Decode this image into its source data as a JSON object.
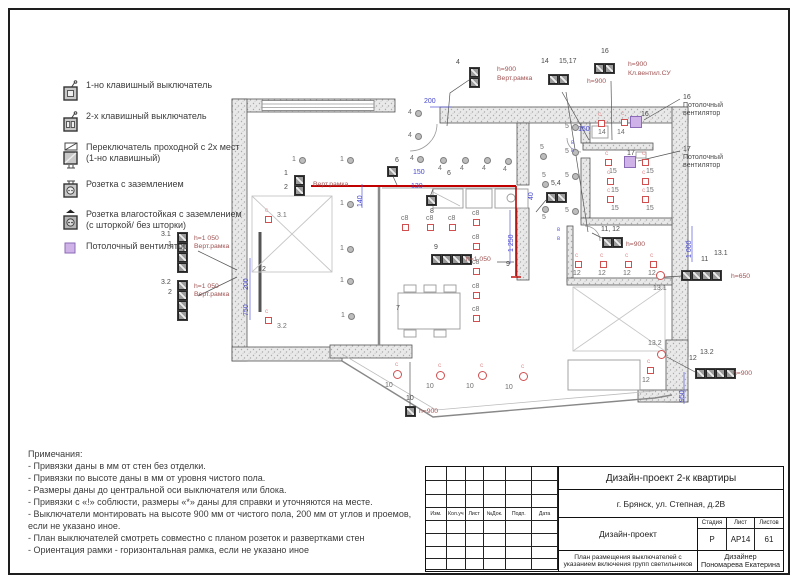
{
  "legend": {
    "items": [
      {
        "icon": "switch-1key-icon",
        "label": "1-но клавишный выключатель"
      },
      {
        "icon": "switch-2key-icon",
        "label": "2-х клавишный выключатель"
      },
      {
        "icon": "switch-pass-icon",
        "label": "Переключатель проходной с 2х мест (1-но клавишный)"
      },
      {
        "icon": "socket-ground-icon",
        "label": "Розетка с заземлением"
      },
      {
        "icon": "socket-wet-icon",
        "label": "Розетка влагостойкая с заземлением (с шторкой/ без шторки)"
      },
      {
        "icon": "ceiling-fan-icon",
        "label": "Потолочный вентилятор"
      }
    ]
  },
  "notes": {
    "title": "Примечания:",
    "lines": [
      "- Привязки даны в мм от стен без отделки.",
      "- Привязки по высоте даны в мм от уровня чистого пола.",
      "- Размеры даны до центральной оси выключателя или блока.",
      "- Привязки с «!» соблюсти, размеры «*» даны для справки и уточняются на месте.",
      "- Выключатели монтировать на высоте 900 мм от чистого пола, 200 мм от углов и проемов, если не указано иное.",
      "- План выключателей смотреть совместно с планом розеток и развертками стен",
      "- Ориентация рамки - горизонтальная рамка, если не указано иное"
    ]
  },
  "title_block": {
    "project": "Дизайн-проект 2-к квартиры",
    "address": "г. Брянск, ул. Степная, д.2В",
    "doc_type": "Дизайн-проект",
    "stage_label": "Стадия",
    "sheet_label": "Лист",
    "sheets_label": "Листов",
    "stage": "Р",
    "sheet": "АР14",
    "sheets": "61",
    "drawing_title": "План размещения выключателей с указанием включения групп светильников",
    "designer_label": "Дизайнер",
    "designer_name": "Пономарева Екатерина",
    "stamp_headers": [
      "Изм.",
      "Кол.уч",
      "Лист",
      "№Док.",
      "Подп.",
      "Дата"
    ]
  },
  "plan": {
    "ceiling_lights": [
      [
        302,
        160,
        "1",
        -10,
        -4
      ],
      [
        350,
        160,
        "1",
        -10,
        -4
      ],
      [
        350,
        204,
        "1",
        -10,
        -4
      ],
      [
        350,
        249,
        "1",
        -10,
        -4
      ],
      [
        350,
        281,
        "1",
        -10,
        -4
      ],
      [
        351,
        316,
        "1",
        -10,
        -4
      ],
      [
        418,
        113,
        "4",
        -10,
        -4
      ],
      [
        418,
        136,
        "4",
        -10,
        -4
      ],
      [
        420,
        159,
        "4",
        -10,
        -4
      ],
      [
        443,
        160,
        "4",
        -5,
        5
      ],
      [
        465,
        160,
        "4",
        -5,
        5
      ],
      [
        487,
        160,
        "4",
        -5,
        5
      ],
      [
        508,
        161,
        "4",
        -5,
        5
      ],
      [
        543,
        156,
        "5",
        -3,
        -12
      ],
      [
        575,
        127,
        "5",
        -10,
        -4
      ],
      [
        575,
        152,
        "5",
        -10,
        -4
      ],
      [
        575,
        176,
        "5",
        -10,
        -4
      ],
      [
        575,
        211,
        "5",
        -10,
        -4
      ],
      [
        545,
        184,
        "5",
        -3,
        -12
      ],
      [
        545,
        209,
        "5",
        -3,
        5
      ]
    ],
    "wall_lights_sq": [
      [
        268,
        219,
        "3.1",
        9,
        -7,
        true
      ],
      [
        268,
        320,
        "3.2",
        9,
        3,
        true
      ],
      [
        601,
        123,
        "14",
        -3,
        6,
        true
      ],
      [
        624,
        122,
        "14",
        -7,
        7,
        true
      ],
      [
        608,
        162,
        "15",
        1,
        6,
        true
      ],
      [
        645,
        162,
        "15",
        1,
        6,
        true
      ],
      [
        610,
        181,
        "15",
        1,
        6,
        true
      ],
      [
        645,
        181,
        "15",
        1,
        6,
        true
      ],
      [
        610,
        199,
        "15",
        1,
        6,
        true
      ],
      [
        645,
        199,
        "15",
        1,
        6,
        true
      ],
      [
        578,
        264,
        "12",
        -5,
        6,
        true
      ],
      [
        603,
        264,
        "12",
        -5,
        6,
        true
      ],
      [
        628,
        264,
        "12",
        -5,
        6,
        true
      ],
      [
        653,
        264,
        "12",
        -5,
        6,
        true
      ],
      [
        650,
        370,
        "12",
        -8,
        7,
        true
      ],
      [
        405,
        227,
        "с8",
        -4,
        -12,
        false
      ],
      [
        430,
        227,
        "с8",
        -4,
        -12,
        false
      ],
      [
        452,
        227,
        "с8",
        -4,
        -12,
        false
      ],
      [
        476,
        222,
        "с8",
        -4,
        -12,
        false
      ],
      [
        476,
        246,
        "с8",
        -4,
        -12,
        false
      ],
      [
        476,
        271,
        "с8",
        -4,
        -12,
        false
      ],
      [
        476,
        295,
        "с8",
        -4,
        -12,
        false
      ],
      [
        476,
        318,
        "с8",
        -4,
        -12,
        false
      ]
    ],
    "wall_lights_rd": [
      [
        397,
        374,
        "10",
        -12,
        8,
        true
      ],
      [
        440,
        375,
        "10",
        -14,
        8,
        true
      ],
      [
        482,
        375,
        "10",
        -16,
        8,
        true
      ],
      [
        523,
        376,
        "10",
        -18,
        8,
        true
      ],
      [
        660,
        275,
        "13.1",
        -7,
        10,
        false
      ],
      [
        661,
        354,
        "13.2",
        -13,
        -14,
        false
      ]
    ],
    "fans": [
      [
        636,
        122,
        "16",
        5,
        -11
      ],
      [
        630,
        162,
        "17",
        -3,
        -12
      ]
    ],
    "blocks": [
      [
        294,
        175,
        2,
        "v"
      ],
      [
        177,
        232,
        4,
        "v"
      ],
      [
        177,
        280,
        4,
        "v"
      ],
      [
        469,
        67,
        2,
        "v"
      ],
      [
        548,
        74,
        2,
        "h"
      ],
      [
        594,
        63,
        2,
        "h"
      ],
      [
        387,
        166,
        1,
        "h"
      ],
      [
        426,
        195,
        1,
        "h"
      ],
      [
        546,
        192,
        2,
        "h"
      ],
      [
        431,
        254,
        4,
        "h"
      ],
      [
        602,
        237,
        2,
        "h"
      ],
      [
        681,
        270,
        4,
        "h"
      ],
      [
        695,
        368,
        4,
        "h"
      ],
      [
        405,
        406,
        1,
        "h"
      ]
    ],
    "labels": [
      [
        284,
        170,
        "1"
      ],
      [
        284,
        184,
        "2"
      ],
      [
        161,
        231,
        "3.1"
      ],
      [
        168,
        241,
        "1"
      ],
      [
        161,
        279,
        "3.2"
      ],
      [
        168,
        289,
        "2"
      ],
      [
        456,
        59,
        "4"
      ],
      [
        541,
        58,
        "14"
      ],
      [
        559,
        58,
        "15,17"
      ],
      [
        601,
        48,
        "16"
      ],
      [
        395,
        157,
        "6"
      ],
      [
        430,
        208,
        "8"
      ],
      [
        551,
        180,
        "5,4"
      ],
      [
        434,
        244,
        "9"
      ],
      [
        601,
        226,
        "11, 12"
      ],
      [
        701,
        256,
        "11"
      ],
      [
        714,
        250,
        "13.1"
      ],
      [
        689,
        355,
        "12"
      ],
      [
        700,
        349,
        "13.2"
      ],
      [
        406,
        395,
        "10"
      ],
      [
        447,
        170,
        "6"
      ],
      [
        396,
        305,
        "7"
      ],
      [
        506,
        261,
        "9"
      ],
      [
        262,
        266,
        "2"
      ],
      [
        683,
        94,
        "16"
      ],
      [
        683,
        102,
        "Потолочный"
      ],
      [
        683,
        110,
        "вентилятор"
      ],
      [
        683,
        146,
        "17"
      ],
      [
        683,
        154,
        "Потолочный"
      ],
      [
        683,
        162,
        "вентилятор"
      ]
    ],
    "annotations": [
      [
        313,
        181,
        "Верт.рамка"
      ],
      [
        194,
        235,
        "h=1 050"
      ],
      [
        194,
        243,
        "Верт.рамка"
      ],
      [
        194,
        283,
        "h=1 050"
      ],
      [
        194,
        291,
        "Верт.рамка"
      ],
      [
        497,
        66,
        "h=900"
      ],
      [
        497,
        75,
        "Верт.рамка"
      ],
      [
        587,
        78,
        "h=900"
      ],
      [
        628,
        61,
        "h=900"
      ],
      [
        628,
        70,
        "Кл.вентил.СУ"
      ],
      [
        466,
        256,
        "h=1 050"
      ],
      [
        626,
        241,
        "h=900"
      ],
      [
        731,
        273,
        "h=650"
      ],
      [
        733,
        370,
        "h=900"
      ],
      [
        419,
        408,
        "h=900"
      ]
    ],
    "dimensions": [
      [
        424,
        98,
        "200",
        "h"
      ],
      [
        578,
        126,
        "150",
        "h"
      ],
      [
        413,
        169,
        "150",
        "h"
      ],
      [
        411,
        183,
        "130",
        "h"
      ],
      [
        357,
        207,
        "140",
        "v"
      ],
      [
        508,
        252,
        "1 250",
        "v"
      ],
      [
        686,
        258,
        "1 000",
        "v"
      ],
      [
        679,
        402,
        "950",
        "v"
      ],
      [
        243,
        290,
        "200",
        "v"
      ],
      [
        243,
        316,
        "750",
        "v"
      ],
      [
        528,
        200,
        "40",
        "v"
      ]
    ],
    "bmarks": [
      [
        571,
        140,
        "в"
      ],
      [
        571,
        148,
        "в"
      ],
      [
        557,
        227,
        "в"
      ],
      [
        557,
        236,
        "в"
      ]
    ]
  }
}
